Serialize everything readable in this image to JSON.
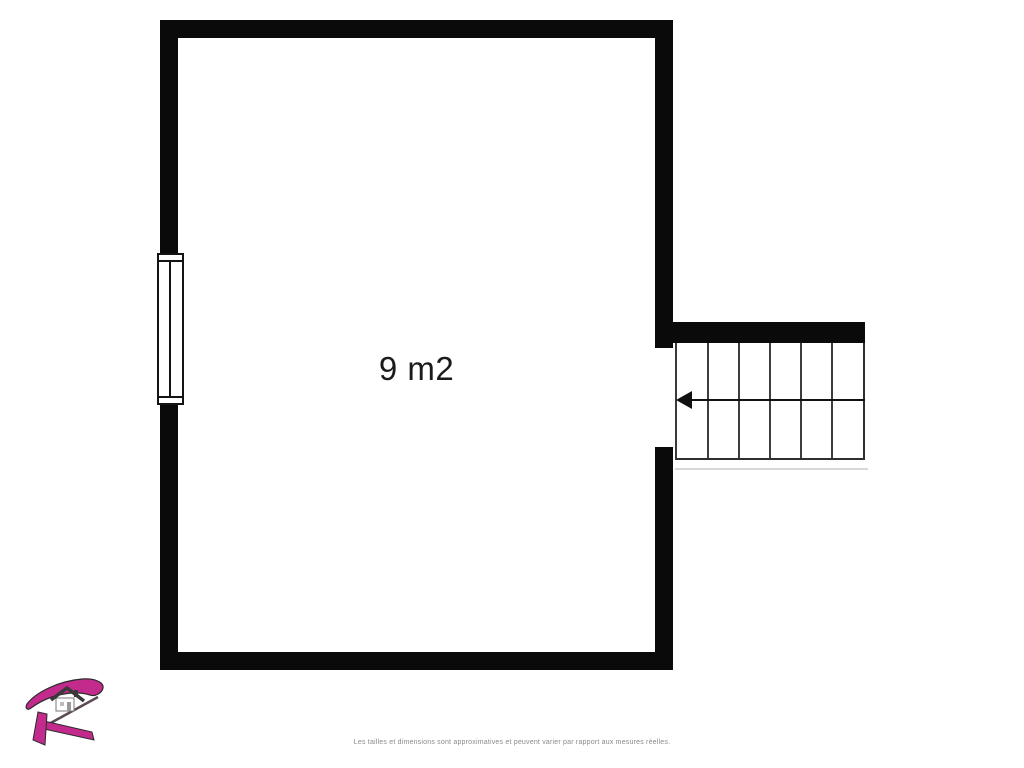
{
  "title": "Floor plan",
  "floor_plan": {
    "room_label": "9 m2",
    "wall_color": "#0a0a0a",
    "window_side": "left",
    "door_opening_side": "right",
    "stairs": {
      "steps": 6,
      "direction_arrow": "left"
    }
  },
  "branding": {
    "logo": "agency-logo-R-with-house",
    "logo_color": "#c22b8c"
  },
  "footer": {
    "disclaimer": "Les tailles et dimensions sont approximatives et peuvent varier par rapport aux mesures réelles."
  }
}
